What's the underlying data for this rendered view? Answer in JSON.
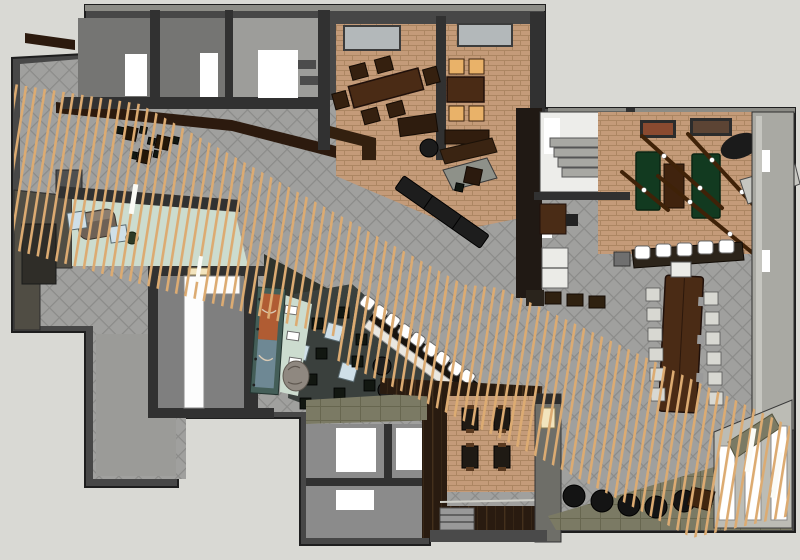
{
  "meta": {
    "title": "3d-floor-plan-render-restaurant",
    "software_style": "sketchup-axonometric",
    "canvas": {
      "width": 800,
      "height": 560
    },
    "visible_text": []
  },
  "palette": {
    "bg": "#d9d9d4",
    "wallOuter": "#474747",
    "wallInner": "#313131",
    "wallTop": "#8c8c86",
    "hallBase": "#a0a09e",
    "hallLine": "#8b8b89",
    "brickBase": "#c49b79",
    "brickLine": "#ac8662",
    "woodBase": "#291b10",
    "woodLine": "#44301c",
    "slat": "#dcab72",
    "slatWhite": "#fbfbf6",
    "mint": "#ccdccf",
    "blueTable": "#cfdfe8",
    "loungeFloor": "#3a403d",
    "feltGreen": "#123a20",
    "amber": "#e9b269",
    "tableWood": "#4a2b15",
    "oliveBase": "#7b7a64",
    "oliveLine": "#67664f",
    "oliveWall": "#504d44",
    "skylight": "#b3b8ba",
    "artOrange": "#b05c33",
    "artBlue": "#6e8894",
    "tealFrame": "#445e58",
    "stoneDesk": "#6e6156",
    "roomGray": "#757573",
    "roomGrayLight": "#9d9d9a",
    "windowPane": "#bcbcb5",
    "rightWall": "#a9a9a3",
    "beamBrown": "#3f2208",
    "creamLight": "#f2e4bd",
    "gravel": "#2f332c",
    "sofaWhite": "#ebebe7",
    "chairGray": "#d8d8d2",
    "columnGray": "#6e6e68",
    "stepGray": "#a8a8a3",
    "canopyBrown": "#2c1a0e",
    "leatherBrown": "#40250f",
    "benchBlack": "#1d1d1d",
    "cubeBlack": "#121711",
    "counterDark": "#18130e",
    "deskBrown": "#4a2c16",
    "white": "#ffffff"
  },
  "scene": {
    "rooms": [
      {
        "name": "back-of-house-room-1",
        "floor": "roomGray"
      },
      {
        "name": "back-of-house-room-2",
        "floor": "roomGray"
      },
      {
        "name": "back-of-house-room-3",
        "floor": "roomGrayLight"
      },
      {
        "name": "private-dining-room-a",
        "floor": "brickBase"
      },
      {
        "name": "private-dining-room-b",
        "floor": "brickBase"
      },
      {
        "name": "servery-host-area",
        "floor": "brickBase"
      },
      {
        "name": "stairwell",
        "floor": "white"
      },
      {
        "name": "games-room",
        "floor": "brickBase"
      },
      {
        "name": "office",
        "floor": "hallBase"
      },
      {
        "name": "communal-dining",
        "floor": "hallBase"
      },
      {
        "name": "main-dining-hall",
        "floor": "hallBase"
      },
      {
        "name": "entry-reception",
        "floor": "mint"
      },
      {
        "name": "corridor-room",
        "floor": "white"
      },
      {
        "name": "lounge",
        "floor": "loungeFloor"
      },
      {
        "name": "fireplace-art-wall",
        "floor": "mint"
      },
      {
        "name": "diagonal-bar",
        "floor": "hallBase"
      },
      {
        "name": "restroom-wing",
        "floor": "roomGrayLight"
      },
      {
        "name": "booth-dining-nook",
        "floor": "brickBase"
      },
      {
        "name": "window-terrace-edge",
        "floor": "windowPane"
      },
      {
        "name": "timber-slat-screen",
        "floor": "slat"
      }
    ],
    "furniture_counts": {
      "private_dining_chairs": 8,
      "communal_table_chairs": 12,
      "bar_stools_diagonal": 9,
      "games_bar_stools": 5,
      "lounge_cube_stools": 9,
      "round_poufs": 5,
      "green_game_tables": 2,
      "booth_tables": 4
    }
  }
}
